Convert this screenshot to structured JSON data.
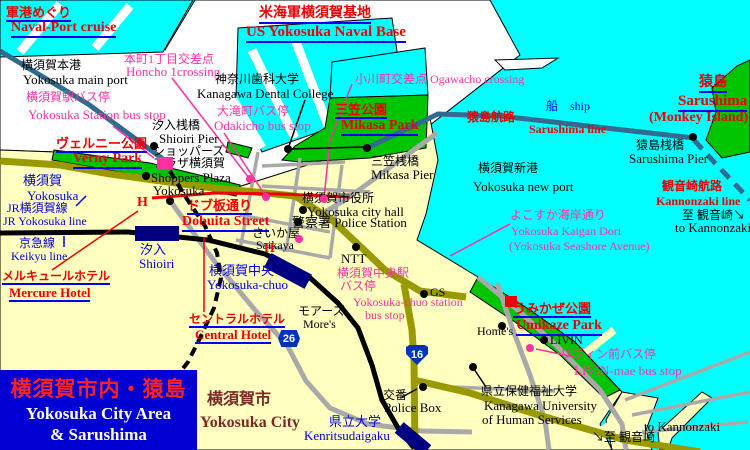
{
  "colors": {
    "water": "#00FFFF",
    "land": "#FFFFC0",
    "base": "#FFFFFF",
    "park": "#00C400",
    "roadMain": "#999900",
    "roadMinor": "#A9A9A9",
    "rail": "#000000",
    "stationBox": "#000080",
    "seaRoute": "#336B8E",
    "red": "#EE0000",
    "magenta": "#FF30A0",
    "blue": "#0000DD",
    "black": "#000000",
    "maroon": "#7B2828",
    "underline": "#0000EE",
    "titleBg": "#0000D2",
    "titleJa": "#FF2222",
    "titleEn": "#FFFFFF",
    "badgeBlue": "#0033BB"
  },
  "title_box": {
    "ja": "横須賀市内・猿島",
    "en_line1": "Yokosuka City Area",
    "en_line2": "& Sarushima"
  },
  "badges": [
    {
      "name": "route-26-badge",
      "text": "26",
      "x": 278,
      "y": 330,
      "shape": "hex"
    },
    {
      "name": "route-16-badge",
      "text": "16",
      "x": 406,
      "y": 345,
      "shape": "shield"
    }
  ],
  "labels": [
    {
      "name": "naval-cruise-ja",
      "text": "軍港めぐり",
      "x": 6,
      "y": 6,
      "cls": "red-u",
      "fs": 13
    },
    {
      "name": "naval-cruise-en",
      "text": "Naval-Port cruise",
      "x": 11,
      "y": 21,
      "cls": "red-u",
      "fs": 14
    },
    {
      "name": "us-base-ja",
      "text": "米海軍横須賀基地",
      "x": 259,
      "y": 7,
      "cls": "red-u",
      "fs": 14
    },
    {
      "name": "us-base-en",
      "text": "US Yokosuka Naval Base",
      "x": 246,
      "y": 25,
      "cls": "red-u",
      "fs": 15
    },
    {
      "name": "mikasa-park-ja",
      "text": "三笠公園",
      "x": 335,
      "y": 103,
      "cls": "red-u",
      "fs": 13
    },
    {
      "name": "mikasa-park-en",
      "text": "Mikasa Park",
      "x": 341,
      "y": 119,
      "cls": "red-u",
      "fs": 14
    },
    {
      "name": "verny-park-ja",
      "text": "ヴェルニー公園",
      "x": 56,
      "y": 137,
      "cls": "red-u",
      "fs": 13
    },
    {
      "name": "verny-park-en",
      "text": "Verny Park",
      "x": 73,
      "y": 152,
      "cls": "red-u",
      "fs": 14
    },
    {
      "name": "dobuita-ja",
      "text": "ドブ板通り",
      "x": 187,
      "y": 199,
      "cls": "red-u",
      "fs": 13
    },
    {
      "name": "dobuita-en",
      "text": "Dobuita Street",
      "x": 182,
      "y": 215,
      "cls": "red-u",
      "fs": 14
    },
    {
      "name": "sarushima-ja",
      "text": "猿島",
      "x": 699,
      "y": 76,
      "cls": "red-u",
      "fs": 14
    },
    {
      "name": "sarushima-en",
      "text": "Sarushima",
      "x": 678,
      "y": 94,
      "cls": "red-u",
      "fs": 15
    },
    {
      "name": "monkey-island",
      "text": "(Monkey Island)",
      "x": 649,
      "y": 111,
      "cls": "red",
      "fs": 14
    },
    {
      "name": "umikaze-park-ja",
      "text": "うみかぜ公園",
      "x": 513,
      "y": 302,
      "cls": "red-u",
      "fs": 13
    },
    {
      "name": "umikaze-park-en",
      "text": "Umikaze Park",
      "x": 516,
      "y": 319,
      "cls": "red-u",
      "fs": 14
    },
    {
      "name": "mercure-hotel-ja",
      "text": "メルキュールホテル",
      "x": 2,
      "y": 270,
      "cls": "red-u",
      "fs": 12
    },
    {
      "name": "mercure-hotel-en",
      "text": "Mercure Hotel",
      "x": 9,
      "y": 286,
      "cls": "red-u",
      "fs": 13
    },
    {
      "name": "central-hotel-ja",
      "text": "セントラルホテル",
      "x": 189,
      "y": 313,
      "cls": "red-u",
      "fs": 12
    },
    {
      "name": "central-hotel-en",
      "text": "Central Hotel",
      "x": 195,
      "y": 328,
      "cls": "red-u",
      "fs": 13
    },
    {
      "name": "kannonzaki-route-ja",
      "text": "観音崎航路",
      "x": 662,
      "y": 180,
      "cls": "red",
      "fs": 12
    },
    {
      "name": "kannonzaki-route-en",
      "text": "Kannonzaki line",
      "x": 656,
      "y": 195,
      "cls": "red",
      "fs": 12
    },
    {
      "name": "sarushima-route-ja",
      "text": "猿島航路",
      "x": 467,
      "y": 111,
      "cls": "red",
      "fs": 12
    },
    {
      "name": "sarushima-route-en",
      "text": "Sarushima line",
      "x": 529,
      "y": 123,
      "cls": "red",
      "fs": 12
    },
    {
      "name": "yokosuka-station-bus-ja",
      "text": "横須賀駅バス停",
      "x": 26,
      "y": 91,
      "cls": "mag",
      "fs": 12
    },
    {
      "name": "yokosuka-station-bus-en",
      "text": "Yokosuka Station bus stop",
      "x": 28,
      "y": 108,
      "cls": "mag",
      "fs": 13
    },
    {
      "name": "honcho-crossing-ja",
      "text": "本町1丁目交差点",
      "x": 124,
      "y": 53,
      "cls": "mag",
      "fs": 12
    },
    {
      "name": "honcho-crossing-en",
      "text": "Honcho 1crossing",
      "x": 126,
      "y": 65,
      "cls": "mag",
      "fs": 13
    },
    {
      "name": "odakicho-bus-ja",
      "text": "大滝町バス停",
      "x": 217,
      "y": 105,
      "cls": "mag",
      "fs": 12
    },
    {
      "name": "odakicho-bus-en",
      "text": "Odakicho bus stop",
      "x": 214,
      "y": 119,
      "cls": "mag",
      "fs": 13
    },
    {
      "name": "ogawacho-crossing",
      "text": "小川町交差点 Ogawacho crossing",
      "x": 355,
      "y": 73,
      "cls": "mag",
      "fs": 12
    },
    {
      "name": "chuo-bus-line1",
      "text": "横須賀中央駅",
      "x": 337,
      "y": 267,
      "cls": "mag",
      "fs": 12
    },
    {
      "name": "chuo-bus-line2",
      "text": "バス停",
      "x": 340,
      "y": 280,
      "cls": "mag",
      "fs": 12
    },
    {
      "name": "chuo-bus-line3",
      "text": "Yokosuka-chuo station",
      "x": 353,
      "y": 296,
      "cls": "mag",
      "fs": 12
    },
    {
      "name": "chuo-bus-line4",
      "text": "bus stop",
      "x": 365,
      "y": 309,
      "cls": "mag",
      "fs": 12
    },
    {
      "name": "livin-bus-ja",
      "text": "リヴィン前バス停",
      "x": 560,
      "y": 348,
      "cls": "mag",
      "fs": 12
    },
    {
      "name": "livin-bus-en",
      "text": "LIVIN-mae bus stop",
      "x": 574,
      "y": 364,
      "cls": "mag",
      "fs": 13
    },
    {
      "name": "kaigan-dori-line1",
      "text": "よこすか海岸通り",
      "x": 510,
      "y": 209,
      "cls": "mag",
      "fs": 12
    },
    {
      "name": "kaigan-dori-line2",
      "text": "Yokosuka Kaigan Dori",
      "x": 511,
      "y": 225,
      "cls": "mag",
      "fs": 12
    },
    {
      "name": "kaigan-dori-line3",
      "text": "(Yokosuka Seashore Avenue)",
      "x": 509,
      "y": 240,
      "cls": "mag",
      "fs": 12
    },
    {
      "name": "yokosuka-sta-ja",
      "text": "横須賀",
      "x": 23,
      "y": 174,
      "cls": "blu",
      "fs": 13
    },
    {
      "name": "yokosuka-sta-en",
      "text": "Yokosuka",
      "x": 27,
      "y": 189,
      "cls": "blu",
      "fs": 13
    },
    {
      "name": "jr-line-ja",
      "text": "JR横須賀線",
      "x": 7,
      "y": 202,
      "cls": "blu",
      "fs": 12
    },
    {
      "name": "jr-line-en",
      "text": "JR Yokosuka line",
      "x": 3,
      "y": 215,
      "cls": "blu",
      "fs": 12
    },
    {
      "name": "keikyu-line-ja",
      "text": "京急線",
      "x": 19,
      "y": 237,
      "cls": "blu",
      "fs": 12
    },
    {
      "name": "keikyu-line-en",
      "text": "Keikyu line",
      "x": 11,
      "y": 250,
      "cls": "blu",
      "fs": 12
    },
    {
      "name": "shioiri-sta-ja",
      "text": "汐入",
      "x": 140,
      "y": 243,
      "cls": "blu",
      "fs": 13
    },
    {
      "name": "shioiri-sta-en",
      "text": "Shioiri",
      "x": 139,
      "y": 257,
      "cls": "blu",
      "fs": 13
    },
    {
      "name": "chuo-sta-ja",
      "text": "横須賀中央",
      "x": 209,
      "y": 264,
      "cls": "blu",
      "fs": 13
    },
    {
      "name": "chuo-sta-en",
      "text": "Yokosuka-chuo",
      "x": 207,
      "y": 278,
      "cls": "blu",
      "fs": 13
    },
    {
      "name": "kenritsu-sta-ja",
      "text": "県立大学",
      "x": 329,
      "y": 415,
      "cls": "blu",
      "fs": 13
    },
    {
      "name": "kenritsu-sta-en",
      "text": "Kenritsudaigaku",
      "x": 304,
      "y": 429,
      "cls": "blu",
      "fs": 13
    },
    {
      "name": "ship-label",
      "text": "船　ship",
      "x": 546,
      "y": 100,
      "cls": "blu",
      "fs": 12
    },
    {
      "name": "mainport-ja",
      "text": "横須賀本港",
      "x": 21,
      "y": 59,
      "cls": "blk",
      "fs": 12
    },
    {
      "name": "mainport-en",
      "text": "Yokosuka main port",
      "x": 23,
      "y": 73,
      "cls": "blk",
      "fs": 13
    },
    {
      "name": "dental-college-ja",
      "text": "神奈川歯科大学",
      "x": 215,
      "y": 73,
      "cls": "blk",
      "fs": 12
    },
    {
      "name": "dental-college-en",
      "text": "Kanagawa Dental College",
      "x": 197,
      "y": 87,
      "cls": "blk",
      "fs": 13
    },
    {
      "name": "shioiri-pier-ja",
      "text": "汐入桟橋",
      "x": 152,
      "y": 119,
      "cls": "blk",
      "fs": 12
    },
    {
      "name": "shioiri-pier-en",
      "text": "Shioiri Pier",
      "x": 159,
      "y": 132,
      "cls": "blk",
      "fs": 13
    },
    {
      "name": "shoppers-line1",
      "text": "ショッパーズ",
      "x": 153,
      "y": 145,
      "cls": "blk",
      "fs": 12
    },
    {
      "name": "shoppers-line2",
      "text": "プラザ横須賀",
      "x": 153,
      "y": 157,
      "cls": "blk",
      "fs": 12
    },
    {
      "name": "shoppers-line3",
      "text": "Shoppers Plaza",
      "x": 151,
      "y": 171,
      "cls": "blk",
      "fs": 13
    },
    {
      "name": "shoppers-line4",
      "text": "Yokosuka",
      "x": 153,
      "y": 184,
      "cls": "blk",
      "fs": 13
    },
    {
      "name": "cityhall-ja",
      "text": "横須賀市役所",
      "x": 302,
      "y": 192,
      "cls": "blk",
      "fs": 12
    },
    {
      "name": "cityhall-en",
      "text": "Yokosuka city hall",
      "x": 307,
      "y": 205,
      "cls": "blk",
      "fs": 13
    },
    {
      "name": "police-station",
      "text": "警察署 Police Station",
      "x": 292,
      "y": 216,
      "cls": "blk",
      "fs": 13
    },
    {
      "name": "mikasa-pier-ja",
      "text": "三笠桟橋",
      "x": 371,
      "y": 155,
      "cls": "blk",
      "fs": 12
    },
    {
      "name": "mikasa-pier-en",
      "text": "Mikasa Pier",
      "x": 371,
      "y": 168,
      "cls": "blk",
      "fs": 13
    },
    {
      "name": "newport-ja",
      "text": "横須賀新港",
      "x": 478,
      "y": 162,
      "cls": "blk",
      "fs": 12
    },
    {
      "name": "newport-en",
      "text": "Yokosuka new port",
      "x": 473,
      "y": 180,
      "cls": "blk",
      "fs": 13
    },
    {
      "name": "saikaya-ja",
      "text": "さいか屋",
      "x": 252,
      "y": 227,
      "cls": "blk",
      "fs": 12
    },
    {
      "name": "saikaya-en",
      "text": "Saikaya",
      "x": 256,
      "y": 239,
      "cls": "blk",
      "fs": 12
    },
    {
      "name": "ntt-label",
      "text": "NTT",
      "x": 341,
      "y": 252,
      "cls": "blk",
      "fs": 13
    },
    {
      "name": "gs-label",
      "text": "GS",
      "x": 430,
      "y": 286,
      "cls": "blk",
      "fs": 12
    },
    {
      "name": "mores-ja",
      "text": "モアーズ",
      "x": 298,
      "y": 305,
      "cls": "blk",
      "fs": 12
    },
    {
      "name": "mores-en",
      "text": "More's",
      "x": 303,
      "y": 318,
      "cls": "blk",
      "fs": 12
    },
    {
      "name": "koban-ja",
      "text": "交番",
      "x": 383,
      "y": 389,
      "cls": "blk",
      "fs": 12
    },
    {
      "name": "koban-en",
      "text": "Police Box",
      "x": 384,
      "y": 401,
      "cls": "blk",
      "fs": 13
    },
    {
      "name": "university-line1",
      "text": "県立保健福祉大学",
      "x": 481,
      "y": 385,
      "cls": "blk",
      "fs": 12
    },
    {
      "name": "university-line2",
      "text": "Kanagawa University",
      "x": 484,
      "y": 399,
      "cls": "blk",
      "fs": 13
    },
    {
      "name": "university-line3",
      "text": "of Human Services",
      "x": 482,
      "y": 413,
      "cls": "blk",
      "fs": 13
    },
    {
      "name": "homes-label",
      "text": "Home's",
      "x": 477,
      "y": 325,
      "cls": "blk",
      "fs": 12
    },
    {
      "name": "livin-label",
      "text": "LIVIN",
      "x": 550,
      "y": 334,
      "cls": "blk",
      "fs": 12
    },
    {
      "name": "sarushima-pier-ja",
      "text": "猿島桟橋",
      "x": 636,
      "y": 139,
      "cls": "blk",
      "fs": 12
    },
    {
      "name": "sarushima-pier-en",
      "text": "Sarushima Pier",
      "x": 629,
      "y": 152,
      "cls": "blk",
      "fs": 13
    },
    {
      "name": "to-kannonzaki-right-ja",
      "text": "至 観音崎↘",
      "x": 682,
      "y": 209,
      "cls": "blk",
      "fs": 12
    },
    {
      "name": "to-kannonzaki-right-en",
      "text": "to Kannonzaki",
      "x": 675,
      "y": 221,
      "cls": "blk",
      "fs": 13
    },
    {
      "name": "to-kannonzaki-bottom-ja",
      "text": "↘至 観音崎",
      "x": 592,
      "y": 431,
      "cls": "blk",
      "fs": 12
    },
    {
      "name": "to-kannonzaki-bottom-en",
      "text": "to Kannonzaki",
      "x": 644,
      "y": 420,
      "cls": "blk",
      "fs": 13
    },
    {
      "name": "city-area-ja",
      "text": "横須賀市",
      "x": 207,
      "y": 392,
      "cls": "maroon",
      "fs": 16
    },
    {
      "name": "city-area-en",
      "text": "Yokosuka City",
      "x": 200,
      "y": 415,
      "cls": "maroon",
      "fs": 16
    }
  ],
  "markers": [
    {
      "name": "shoppers-plaza-dot",
      "type": "dot-black",
      "x": 146,
      "y": 176
    },
    {
      "name": "cityhall-dot",
      "type": "dot-black",
      "x": 303,
      "y": 210
    },
    {
      "name": "police-station-dot",
      "type": "dot-black",
      "x": 298,
      "y": 222
    },
    {
      "name": "ntt-dot",
      "type": "dot-black",
      "x": 356,
      "y": 247
    },
    {
      "name": "gs-dot",
      "type": "dot-black",
      "x": 424,
      "y": 294
    },
    {
      "name": "koban-dot",
      "type": "dot-black",
      "x": 423,
      "y": 387
    },
    {
      "name": "university-dot",
      "type": "dot-black",
      "x": 473,
      "y": 367
    },
    {
      "name": "mikasa-pier-dot",
      "type": "dot-black",
      "x": 367,
      "y": 148
    },
    {
      "name": "shioiri-pier-dot",
      "type": "dot-black",
      "x": 154,
      "y": 146
    },
    {
      "name": "dental-college-dot",
      "type": "dot-black",
      "x": 288,
      "y": 149
    },
    {
      "name": "homes-dot",
      "type": "dot-black",
      "x": 502,
      "y": 326
    },
    {
      "name": "livin-dot",
      "type": "dot-black",
      "x": 544,
      "y": 340
    },
    {
      "name": "verny-poi-dot",
      "type": "dot-black",
      "x": 170,
      "y": 201
    },
    {
      "name": "sarushima-pier-dot",
      "type": "dot-black",
      "x": 693,
      "y": 137
    },
    {
      "name": "honcho-crossing-dot",
      "type": "dot-magenta",
      "x": 250,
      "y": 179
    },
    {
      "name": "odakicho-stop-dot",
      "type": "dot-magenta",
      "x": 266,
      "y": 197
    },
    {
      "name": "chuo-stop-dot",
      "type": "dot-magenta",
      "x": 299,
      "y": 239
    },
    {
      "name": "livin-stop-dot",
      "type": "dot-magenta",
      "x": 530,
      "y": 348
    },
    {
      "name": "ogawacho-crossing-dot",
      "type": "dot-magenta",
      "x": 324,
      "y": 199
    },
    {
      "name": "yokosuka-station-marker",
      "type": "square-magenta",
      "x": 157,
      "y": 157,
      "w": 16,
      "h": 12
    },
    {
      "name": "umikaze-marker",
      "type": "square-red",
      "x": 505,
      "y": 296,
      "w": 12,
      "h": 11
    },
    {
      "name": "mercure-hotel-h",
      "type": "hotel-h",
      "x": 137,
      "y": 195,
      "text": "H"
    },
    {
      "name": "central-hotel-h",
      "type": "hotel-h",
      "x": 264,
      "y": 241,
      "text": "H"
    }
  ]
}
